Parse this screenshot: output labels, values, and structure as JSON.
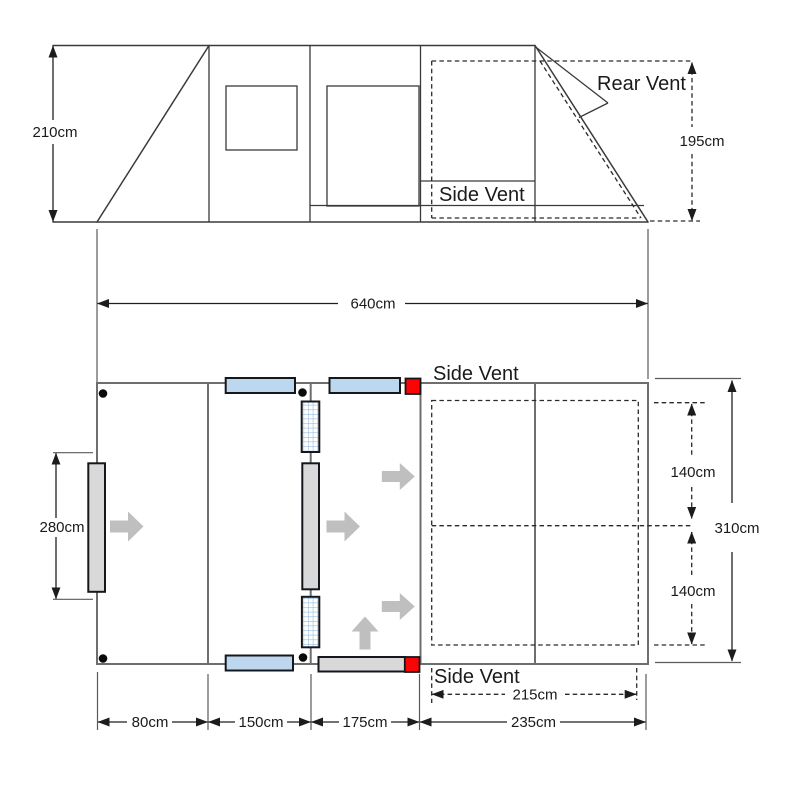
{
  "colors": {
    "window_blue": "#BDD7EE",
    "mesh_grid_blue": "#8FB8DC",
    "door_gray": "#D9D9D9",
    "vent_red": "#FA0505",
    "flow_arrow_gray": "#BFBFBF",
    "wall_gray": "#6E6E6E",
    "line_dark": "#3A3A3A",
    "background": "#FFFFFF"
  },
  "side_view": {
    "height_left": "210cm",
    "height_rear": "195cm",
    "rear_vent": "Rear Vent",
    "side_vent": "Side Vent"
  },
  "overall": {
    "total_length": "640cm"
  },
  "floor_plan": {
    "side_vent_top": "Side Vent",
    "side_vent_bottom": "Side Vent",
    "front_door_height": "280cm",
    "total_width": "310cm",
    "bed_depth_top": "140cm",
    "bed_depth_bottom": "140cm",
    "bed_width": "215cm",
    "sections": [
      "80cm",
      "150cm",
      "175cm",
      "235cm"
    ]
  }
}
